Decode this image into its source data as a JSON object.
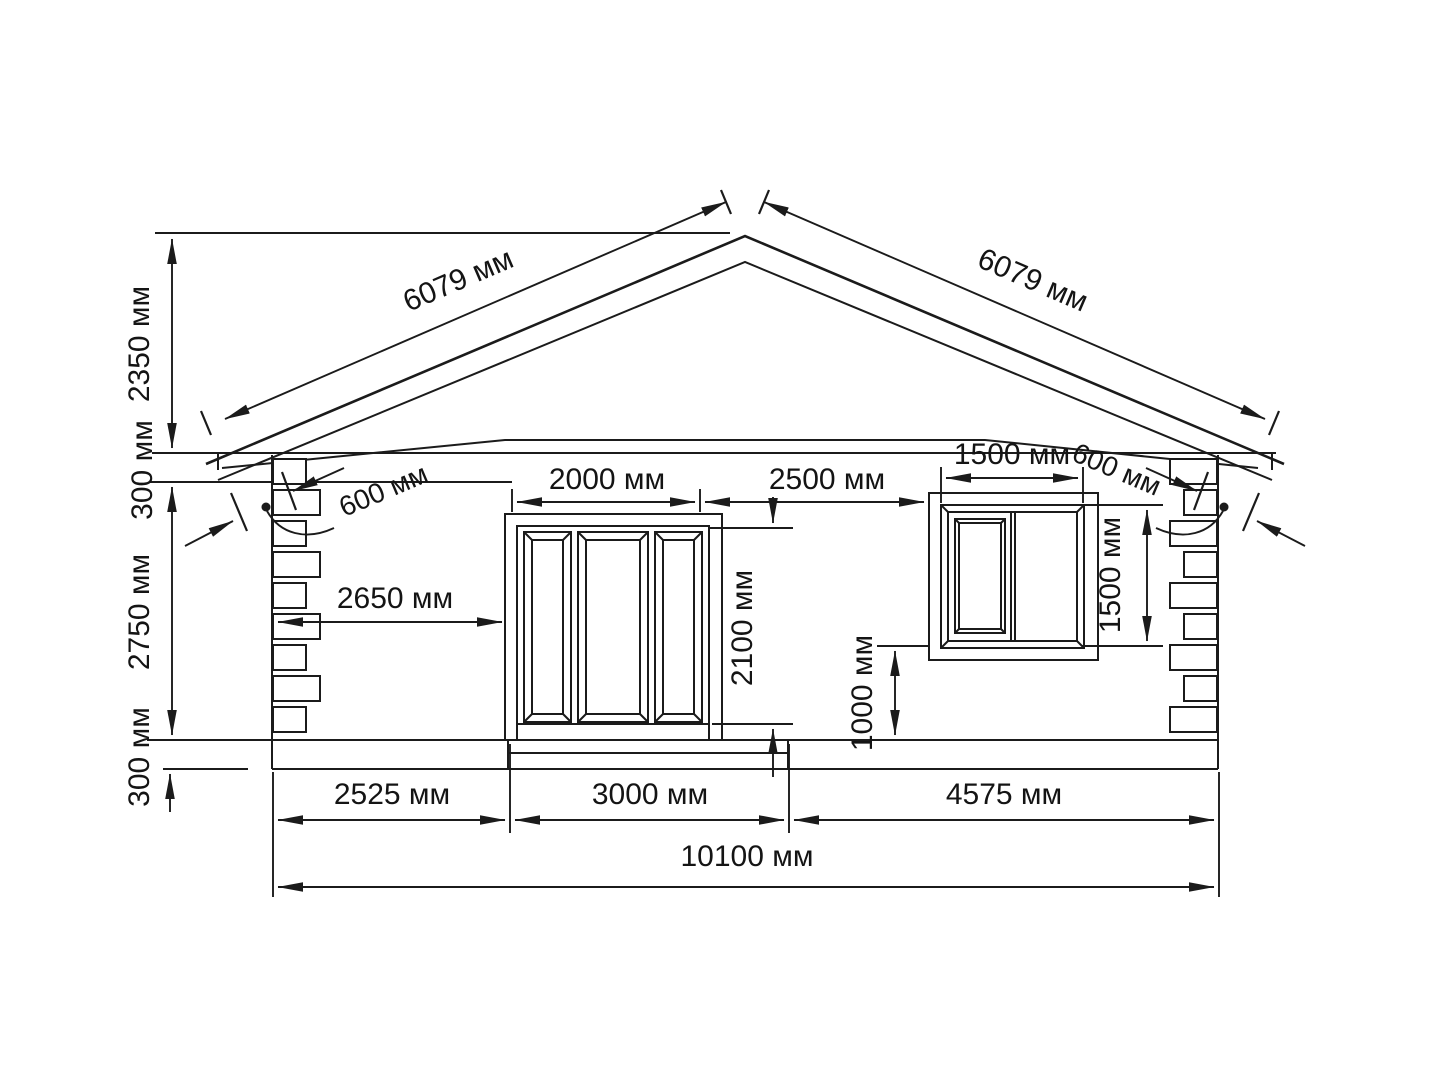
{
  "drawing": {
    "dims": {
      "roof_slope_left": "6079 мм",
      "roof_slope_right": "6079 мм",
      "gable_height": "2350 мм",
      "eave_band_height": "300 мм",
      "wall_height": "2750 мм",
      "plinth_height": "300 мм",
      "eave_overhang_left": "600 мм",
      "eave_overhang_right": "600 мм",
      "door_width": "2000 мм",
      "door_to_window": "2500 мм",
      "window_width": "1500 мм",
      "wall_to_door": "2650 мм",
      "door_height": "2100 мм",
      "window_height": "1500 мм",
      "window_sill_height": "1000 мм",
      "segment_left": "2525 мм",
      "segment_door": "3000 мм",
      "segment_right": "4575 мм",
      "total_width": "10100 мм"
    }
  }
}
